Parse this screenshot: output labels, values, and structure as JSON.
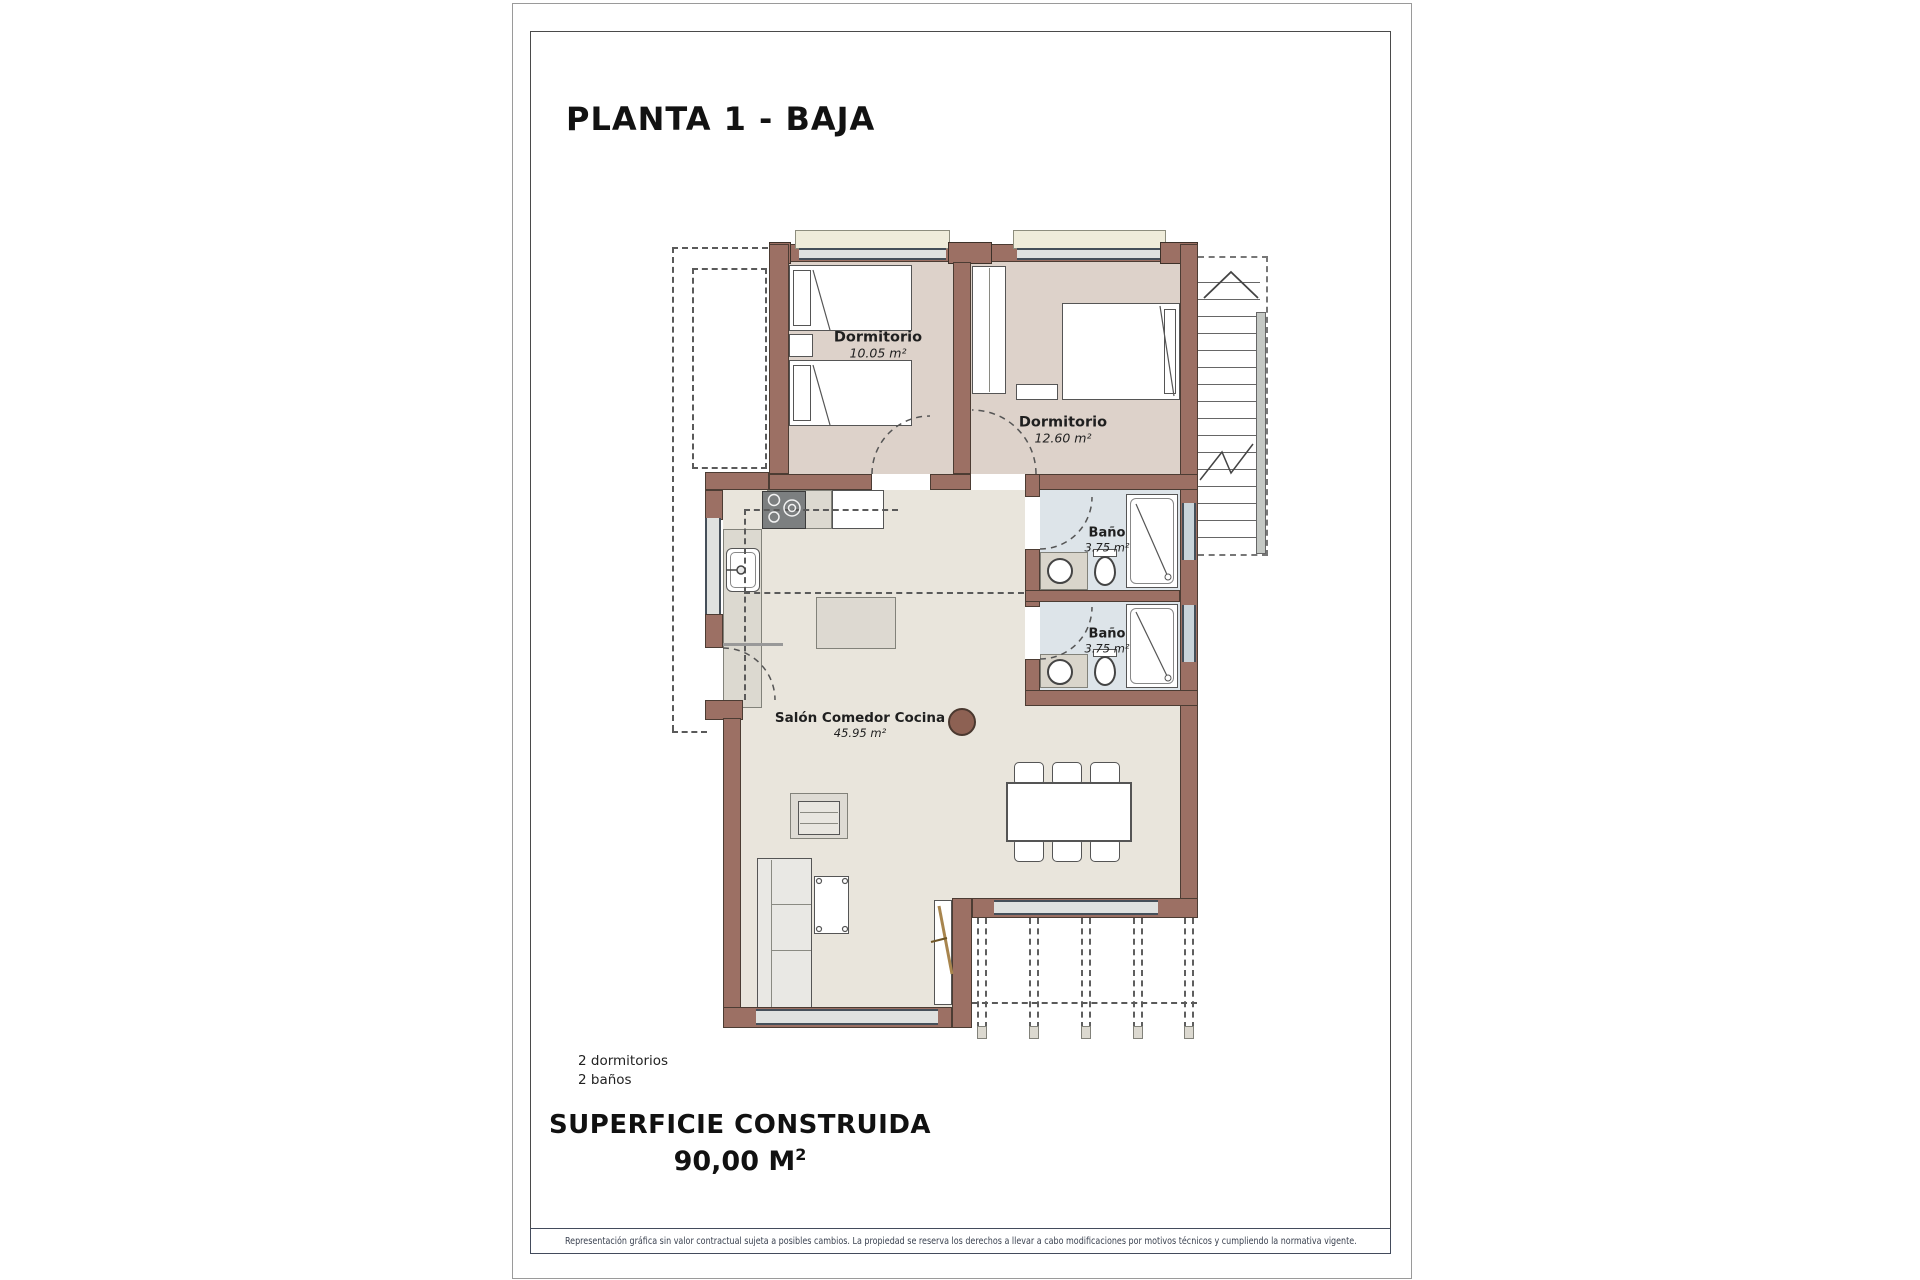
{
  "page": {
    "title": "PLANTA 1 - BAJA",
    "footer_summary": {
      "bedrooms": "2 dormitorios",
      "bathrooms": "2 baños"
    },
    "built_area": {
      "label": "SUPERFICIE CONSTRUIDA",
      "value": "90,00 M",
      "superscript": "2"
    },
    "disclaimer": "Representación gráfica sin valor contractual sujeta a posibles cambios. La propiedad se reserva los derechos a llevar a cabo modificaciones por motivos técnicos y cumpliendo la normativa vigente."
  },
  "plan": {
    "rooms": [
      {
        "name": "Dormitorio",
        "area": "10.05 m²"
      },
      {
        "name": "Dormitorio",
        "area": "12.60 m²"
      },
      {
        "name": "Baño",
        "area": "3.75 m²"
      },
      {
        "name": "Baño",
        "area": "3.75 m²"
      },
      {
        "name": "Salón Comedor Cocina",
        "area": "45.95 m²"
      }
    ]
  },
  "colors": {
    "wall": "#9c7064",
    "bedroom_floor": "#ddd2ca",
    "living_floor": "#e9e5dc",
    "bath_floor": "#dde4e9",
    "page_background": "#ffffff"
  }
}
